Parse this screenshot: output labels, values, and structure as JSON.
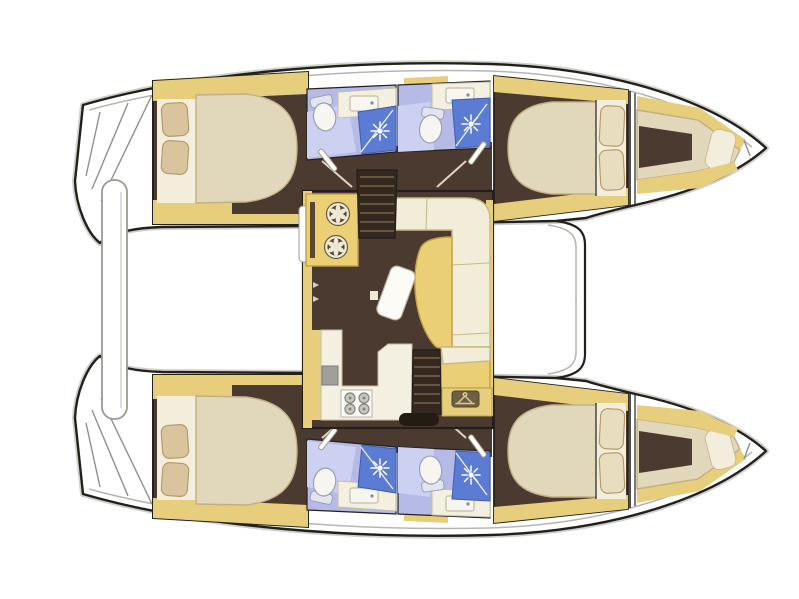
{
  "diagram": {
    "type": "catamaran-interior-floor-plan",
    "view": "top-down",
    "orientation": {
      "bow": "right",
      "stern": "left"
    },
    "counts": {
      "hulls": 2,
      "double_cabins": 4,
      "bathrooms": 4,
      "shower_stalls": 4,
      "forepeak_berths": 2
    },
    "palette": {
      "outline": "#23201b",
      "shadow": "#a9a9a3",
      "deck_line": "#b6b6b0",
      "hull_white": "#ffffff",
      "trim_yellow": "#e6ce7d",
      "floor_brown": "#4b3a30",
      "floor_dark": "#35291f",
      "stair_base": "#241b14",
      "tread": "#7b6450",
      "mattress": "#e1d7bb",
      "mattress_edge": "#c2b084",
      "linen": "#f3eedc",
      "pillow_tan": "#d9c49e",
      "pillow_cream": "#e9ddbf",
      "pillow_edge": "#b59b6e",
      "bath_lavender": "#b5bae7",
      "bath_lavender_light": "#cdd1f1",
      "shower_blue": "#5c7bd3",
      "shower_edge": "#3f5cb0",
      "fixture_white": "#f6f5f0",
      "counter_cream": "#f4f0e1",
      "sofa_cream": "#f2edd8",
      "sofa_edge": "#c8b98a",
      "table_yellow": "#ebcf74",
      "table_edge": "#c2a04a",
      "gray_metal": "#9f9f9b",
      "stove_white": "#fbfaf5",
      "fan_bg": "#55432f",
      "locker_plate": "#6f6044",
      "hanger_light": "#d9c890",
      "door_white": "#fdfdfb"
    },
    "hulls": [
      {
        "name": "port hull (top)",
        "rooms": [
          "aft double cabin with island bed and two pillows",
          "aft bathroom with toilet, sink and separate shower stall",
          "forward bathroom with toilet, sink and separate shower stall",
          "forward double cabin with bed and two pillows",
          "forepeak berth with single pillow"
        ]
      },
      {
        "name": "starboard hull (bottom, mirrored)",
        "rooms": [
          "aft double cabin with island bed and two pillows",
          "aft bathroom with toilet, sink and separate shower stall",
          "forward bathroom with toilet, sink and separate shower stall",
          "forward double cabin with bed and two pillows",
          "forepeak berth with single pillow"
        ]
      }
    ],
    "saloon": {
      "features": [
        "forward cabinet with two round fan fronts",
        "companionway stairs down to port hull",
        "L-shaped settee sofa",
        "curved cocktail table",
        "movable stool",
        "U-shaped galley counter with sink and 4-burner stove",
        "companionway stairs down to starboard hull",
        "chaise seat",
        "hanging wardrobe locker with clothes-hanger sign"
      ]
    },
    "exterior": {
      "features": [
        "stepped transoms with swim platforms",
        "aft crossbeam bench between hulls",
        "forward crossbeam"
      ]
    },
    "icons": {
      "shower": "sunburst",
      "wardrobe": "clothes-hanger",
      "cabinet_front": "fan-wheel",
      "stove": "four-burner-hob",
      "toilet": "bowl-with-tank"
    }
  }
}
